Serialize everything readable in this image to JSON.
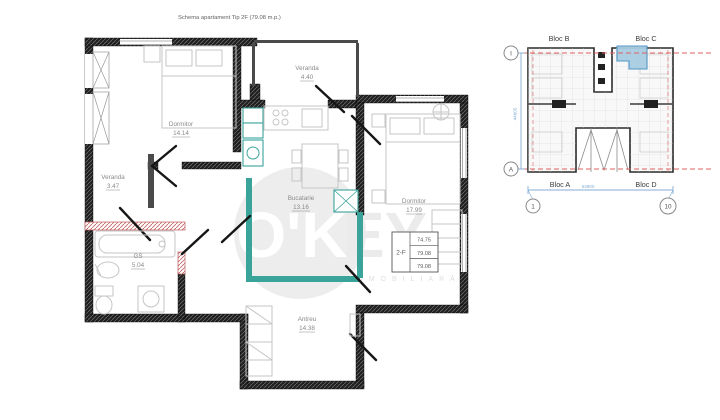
{
  "title": "Schema apartament Tip 2F (79.08 m.p.)",
  "watermark": {
    "logo_left": "O'K",
    "logo_right": "EY",
    "subtitle": "COMPANIE IMOBILIARĂ"
  },
  "rooms": {
    "dormitor_1": {
      "name": "Dormitor",
      "area": "14.14"
    },
    "veranda_1": {
      "name": "Veranda",
      "area": "3.47"
    },
    "veranda_2": {
      "name": "Veranda",
      "area": "4.40"
    },
    "bucatarie": {
      "name": "Bucatarie",
      "area": "13.16"
    },
    "dormitor_2": {
      "name": "Dormitor",
      "area": "17.99"
    },
    "grup_sanitar": {
      "name": "GS",
      "area": "5.04"
    },
    "antreu": {
      "name": "Antreu",
      "area": "14.38"
    }
  },
  "info_table": {
    "unit_type": "2-F",
    "values": [
      "74.75",
      "79.08",
      "79.08"
    ]
  },
  "site_plan": {
    "blocks": {
      "bloc_b": "Bloc B",
      "bloc_c": "Bloc C",
      "bloc_a": "Bloc A",
      "bloc_d": "Bloc D"
    },
    "axis_markers": {
      "top_left": "I",
      "bottom_left": "A",
      "col_start": "1",
      "col_end": "10"
    },
    "dimensions": {
      "horizontal": "53800",
      "vertical": "44600"
    },
    "highlight_color": "#a8cde2"
  },
  "colors": {
    "wall": "#202020",
    "plumbing_accent": "#3aa39a",
    "masonry_accent": "#c96a6a",
    "dimension_blue": "#85aed6",
    "axis_red": "#e06060"
  }
}
